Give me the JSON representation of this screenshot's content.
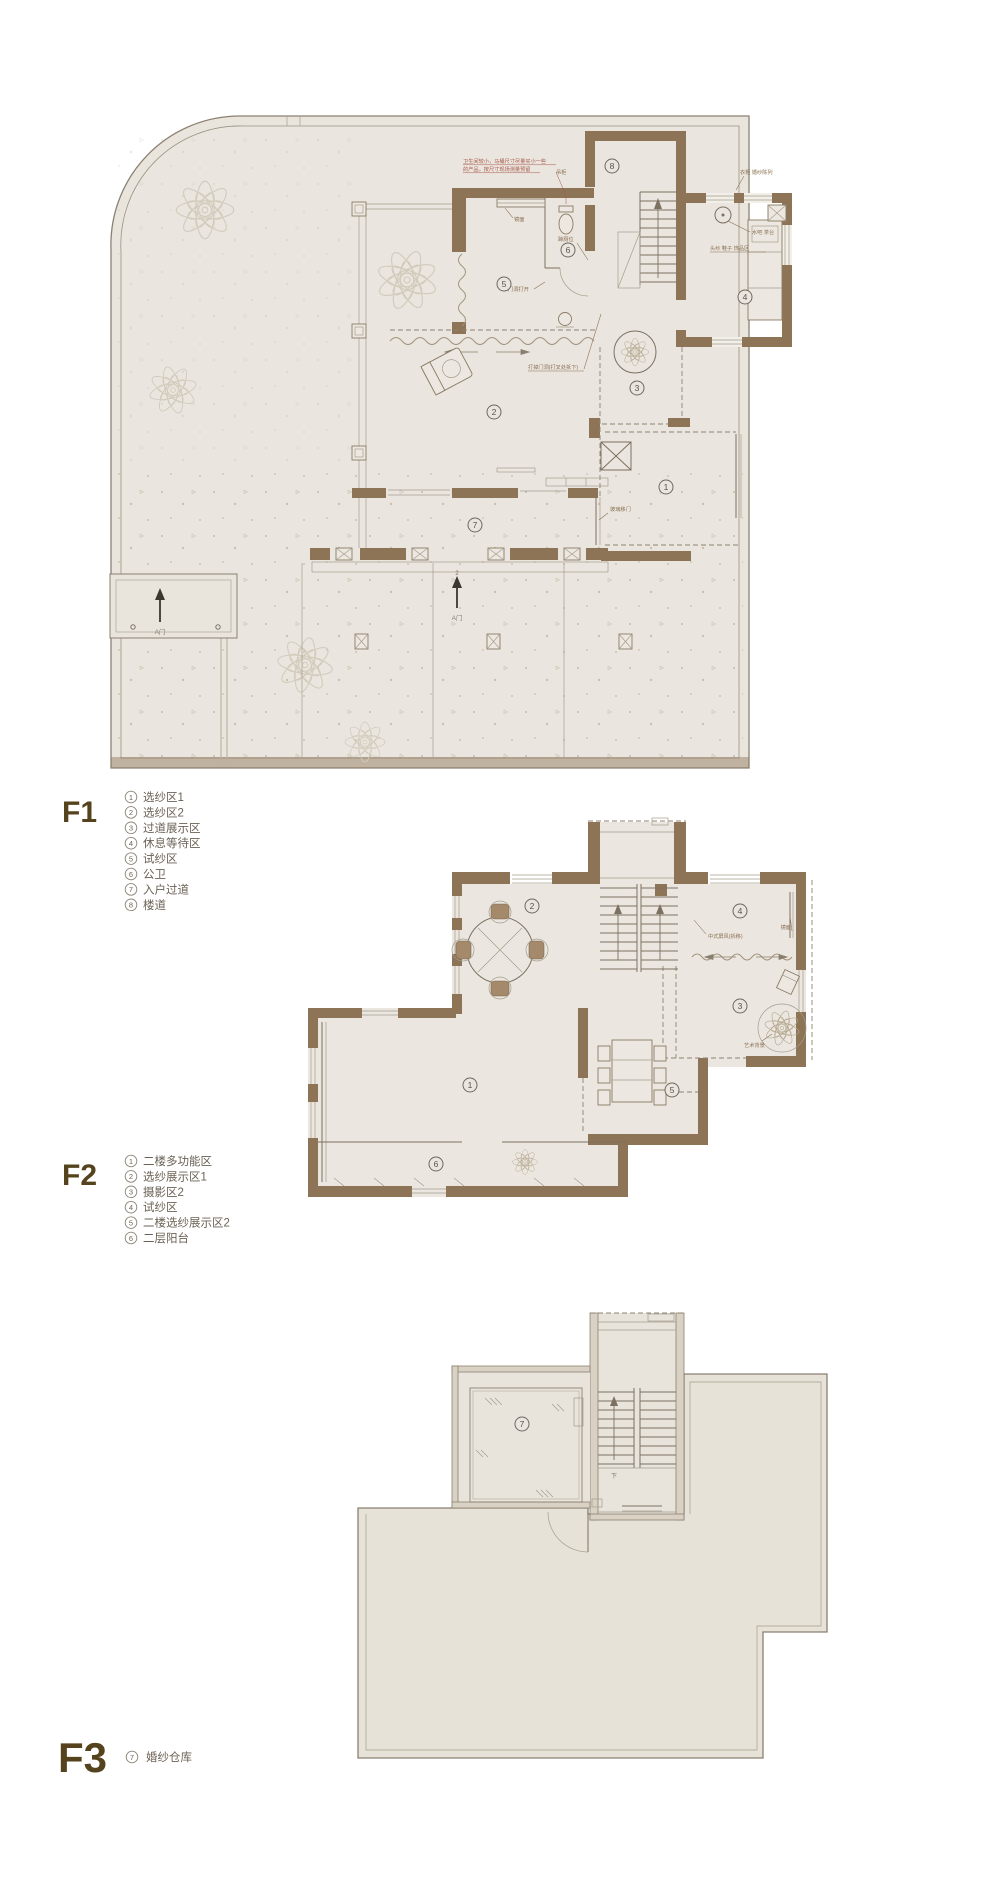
{
  "palette": {
    "wall_brown": "#8e7457",
    "floor_beige": "#eae6df",
    "annotation_red": "#a8584a",
    "label_brown": "#55431e",
    "line_gray": "#7c7061"
  },
  "floors": [
    {
      "label": "F1",
      "legend": [
        {
          "num": "1",
          "label": "选纱区1"
        },
        {
          "num": "2",
          "label": "选纱区2"
        },
        {
          "num": "3",
          "label": "过道展示区"
        },
        {
          "num": "4",
          "label": "休息等待区"
        },
        {
          "num": "5",
          "label": "试纱区"
        },
        {
          "num": "6",
          "label": "公卫"
        },
        {
          "num": "7",
          "label": "入户过道"
        },
        {
          "num": "8",
          "label": "楼道"
        }
      ]
    },
    {
      "label": "F2",
      "legend": [
        {
          "num": "1",
          "label": "二楼多功能区"
        },
        {
          "num": "2",
          "label": "选纱展示区1"
        },
        {
          "num": "3",
          "label": "摄影区2"
        },
        {
          "num": "4",
          "label": "试纱区"
        },
        {
          "num": "5",
          "label": "二楼选纱展示区2"
        },
        {
          "num": "6",
          "label": "二层阳台"
        }
      ]
    },
    {
      "label": "F3",
      "legend": [
        {
          "num": "7",
          "label": "婚纱仓库"
        }
      ]
    }
  ],
  "plan_f1": {
    "annotations": {
      "note_line1": "卫生间较小，马桶尺寸尽量买小一些",
      "note_line2": "的产品，按尺寸现场测量预留",
      "mirror": "镜面",
      "cabinet_left": "吊柜",
      "cabinet_right": "衣柜 婚纱陈列",
      "door_open": "门洞打开",
      "squat_toilet": "蹲厕位",
      "water_bar": "水吧 茶台",
      "accessories": "头纱 鞋子 饰品区",
      "knock_wall": "打掉门洞(打叉处拆下)",
      "glass_door": "玻璃移门",
      "gate_label": "A门",
      "gate_left_label": "A门",
      "gate_number": "2"
    }
  },
  "plan_f2": {
    "annotations": {
      "screen": "中式屏风(拆移)",
      "mirror": "镜面",
      "art_backdrop": "艺术背景"
    }
  },
  "plan_f3": {
    "annotations": {
      "stair_down": "下"
    }
  }
}
